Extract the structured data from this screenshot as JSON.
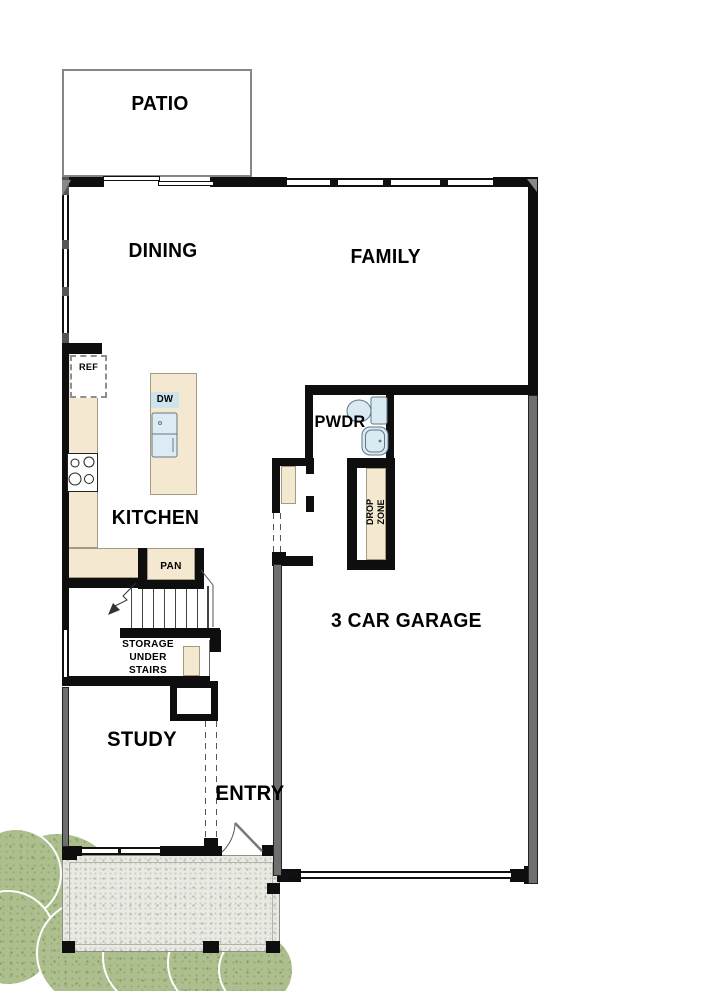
{
  "rooms": {
    "patio": "PATIO",
    "dining": "DINING",
    "family": "FAMILY",
    "kitchen": "KITCHEN",
    "powder": "PWDR",
    "garage": "3 CAR GARAGE",
    "study": "STUDY",
    "entry": "ENTRY"
  },
  "annotations": {
    "refrigerator": "REF",
    "dishwasher": "DW",
    "pantry": "PAN",
    "drop_zone": [
      "DROP",
      "ZONE"
    ],
    "storage_under_stairs": [
      "STORAGE",
      "UNDER",
      "STAIRS"
    ]
  },
  "colors": {
    "wall": "#0e0e0e",
    "exterior_gray": "#6f6f6f",
    "counter": "#f4e9d0",
    "fixture_blue": "#d9eaf3",
    "porch": "#eaeae4",
    "shrub": "#adbf8e"
  }
}
